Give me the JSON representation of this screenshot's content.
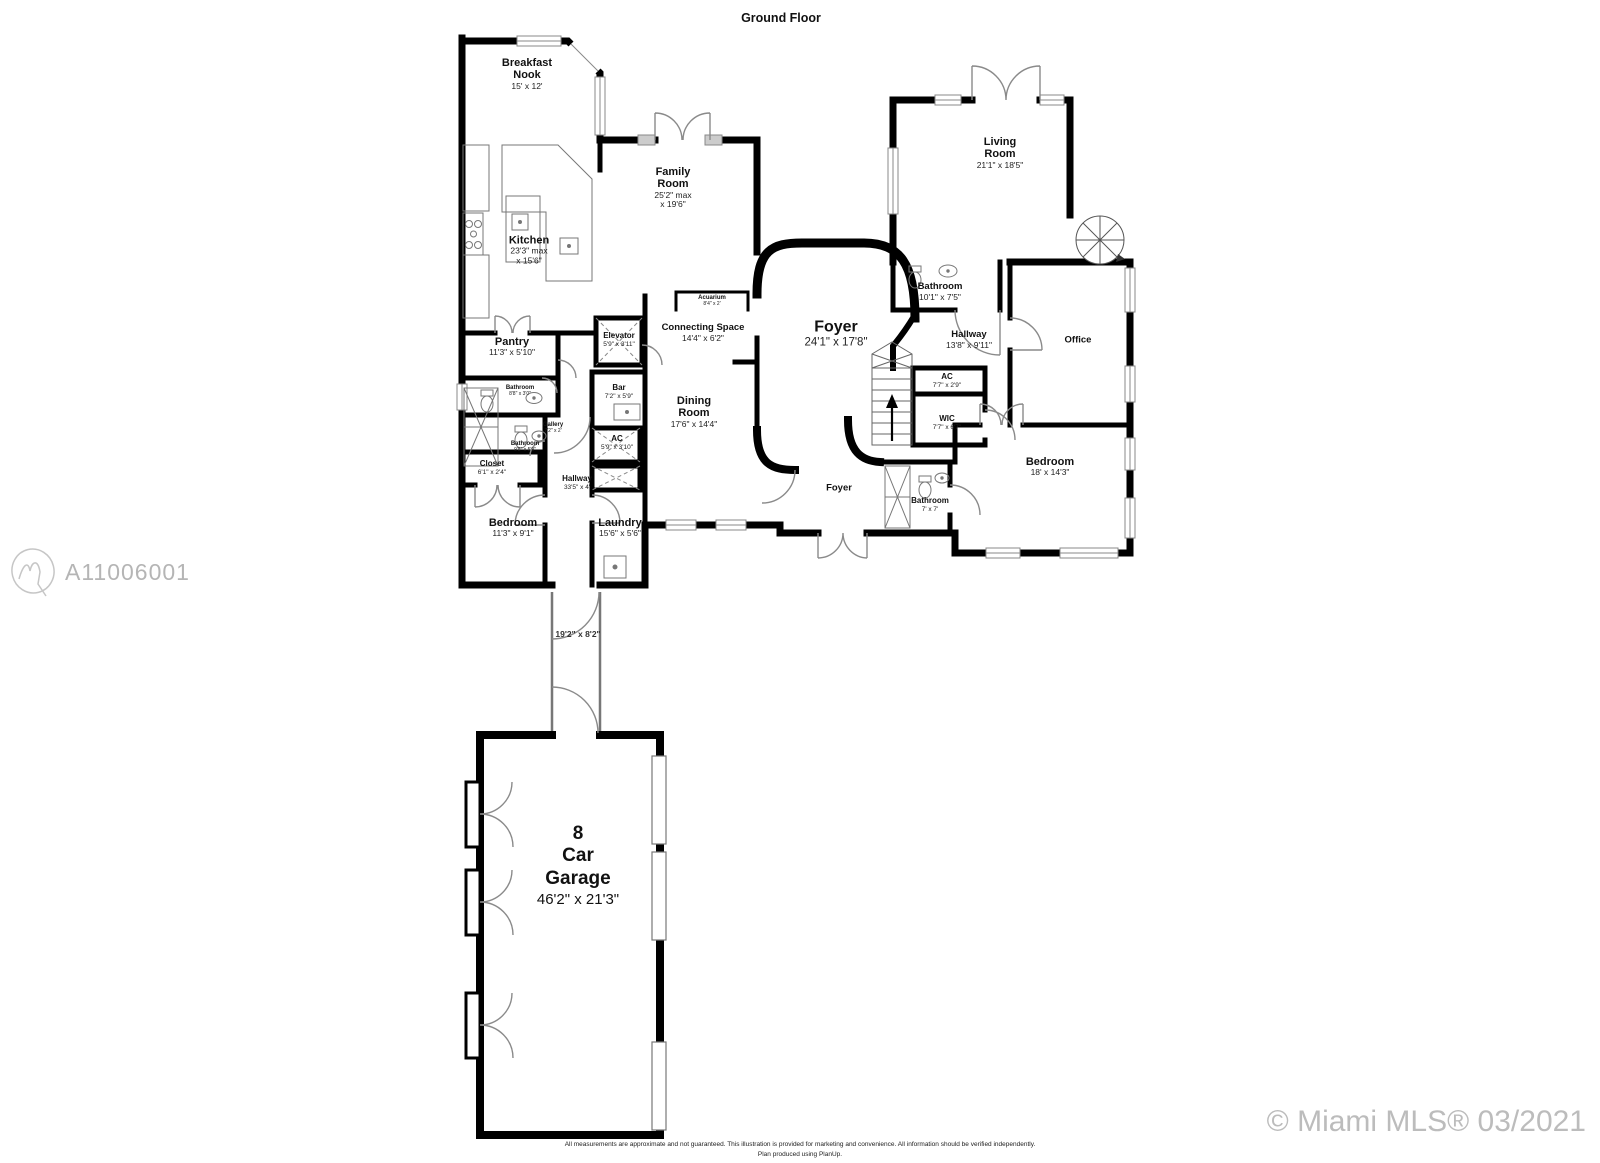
{
  "title": "Ground Floor",
  "watermarks": {
    "listing_id": "A11006001",
    "copyright": "© Miami MLS® 03/2021"
  },
  "footer": {
    "line1": "All measurements are approximate and not guaranteed. This illustration is provided for marketing and convenience. All information should be verified independently.",
    "line2": "Plan produced using PlanUp."
  },
  "rooms": {
    "breakfast_nook": {
      "name": "Breakfast Nook",
      "dims": "15' x 12'"
    },
    "kitchen": {
      "name": "Kitchen",
      "dims": "23'3\" max",
      "dims2": "x 15'6\""
    },
    "family_room": {
      "name": "Family Room",
      "dims": "25'2\" max",
      "dims2": "x 19'6\""
    },
    "living_room": {
      "name": "Living Room",
      "dims": "21'1\" x 18'5\""
    },
    "bathroom_top": {
      "name": "Bathroom",
      "dims": "10'1\" x 7'5\""
    },
    "hallway_right": {
      "name": "Hallway",
      "dims": "13'8\" x 9'11\""
    },
    "office": {
      "name": "Office"
    },
    "foyer": {
      "name": "Foyer",
      "dims": "24'1\" x 17'8\""
    },
    "foyer_small": {
      "name": "Foyer"
    },
    "connecting_space": {
      "name": "Connecting Space",
      "dims": "14'4\" x 6'2\""
    },
    "acuarium": {
      "name": "Acuarium",
      "dims": "8'4\" x 2'"
    },
    "elevator": {
      "name": "Elevator",
      "dims": "5'9\" x 3'11\""
    },
    "pantry": {
      "name": "Pantry",
      "dims": "11'3\" x 5'10\""
    },
    "bar": {
      "name": "Bar",
      "dims": "7'2\" x 5'9\""
    },
    "dining_room": {
      "name": "Dining Room",
      "dims": "17'6\" x 14'4\""
    },
    "ac_right": {
      "name": "AC",
      "dims": "7'7\" x 2'9\""
    },
    "wic": {
      "name": "WIC",
      "dims": "7'7\" x 6'7\""
    },
    "bathroom_right": {
      "name": "Bathroom",
      "dims": "7' x 7'"
    },
    "bedroom_right": {
      "name": "Bedroom",
      "dims": "18' x 14'3\""
    },
    "bathroom_small_upper": {
      "name": "Bathroom",
      "dims": "8'8\" x 3'0\""
    },
    "bathroom_small_lower": {
      "name": "Bathroom",
      "dims": "9'8\" x 5'9\""
    },
    "gallery": {
      "name": "Gallery",
      "dims": "7'2\" x 2'"
    },
    "closet": {
      "name": "Closet",
      "dims": "6'1\" x 2'4\""
    },
    "hallway_left": {
      "name": "Hallway",
      "dims": "33'5\" x 4'"
    },
    "ac_left": {
      "name": "AC",
      "dims": "5'9\" x 3'10\""
    },
    "bedroom_left": {
      "name": "Bedroom",
      "dims": "11'3\" x 9'1\""
    },
    "laundry": {
      "name": "Laundry",
      "dims": "15'6\" x 5'6\""
    },
    "passage": {
      "dims": "19'2\" x 8'2\""
    },
    "garage": {
      "line1": "8",
      "line2": "Car",
      "line3": "Garage",
      "dims": "46'2\" x 21'3\""
    }
  }
}
